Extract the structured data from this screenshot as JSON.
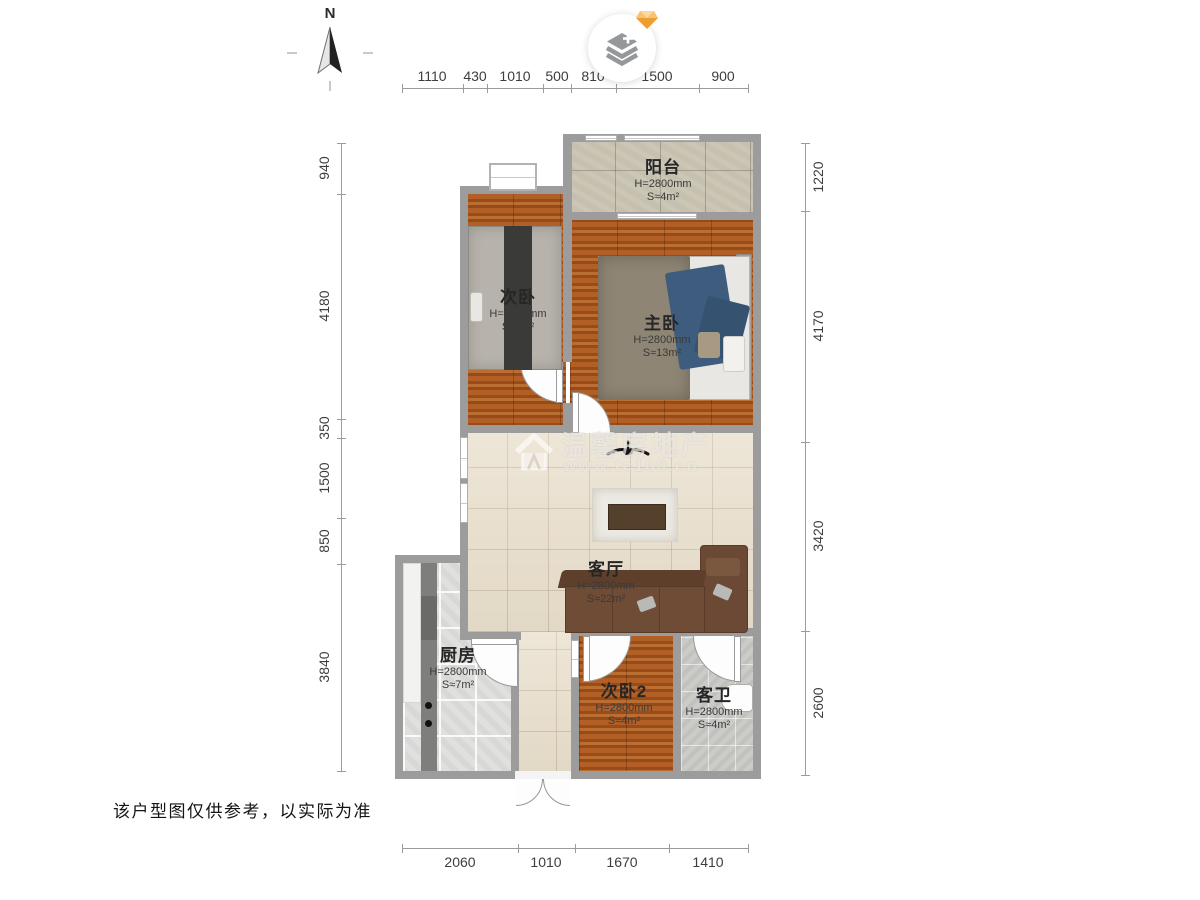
{
  "page": {
    "disclaimer": "该户型图仅供参考，以实际为准",
    "watermark": {
      "brand": "温馨房地产",
      "url": "www.tc100.cn"
    }
  },
  "compass": {
    "label": "N"
  },
  "icons": {
    "layers_button": "layers-plus-icon",
    "badge": "gem-icon",
    "compass": "north-arrow-icon",
    "fan": "ceiling-fan-icon",
    "watermark_logo": "house-logo-icon"
  },
  "colors": {
    "wall": "#9c9c9c",
    "wood_floor": "#a8561f",
    "tile_living": "#e9dfcc",
    "tile_kitchen": "#e0e0de",
    "tile_bath": "#cbcbc8",
    "tile_balcony": "#c6c0ae",
    "sofa": "#6b4934",
    "badge_accent": "#f4a93c"
  },
  "dimensions": {
    "top": [
      "1110",
      "430",
      "1010",
      "500",
      "810",
      "1500",
      "900"
    ],
    "left": [
      "940",
      "4180",
      "350",
      "1500",
      "850",
      "3840"
    ],
    "right": [
      "1220",
      "4170",
      "3420",
      "2600"
    ],
    "bottom": [
      "2060",
      "1010",
      "1670",
      "1410"
    ]
  },
  "rooms": {
    "balcony": {
      "name": "阳台",
      "height": "H=2800mm",
      "area": "S≈4m²"
    },
    "bedroom2": {
      "name": "次卧",
      "height": "H=2800mm",
      "area": "S≈8m²"
    },
    "master": {
      "name": "主卧",
      "height": "H=2800mm",
      "area": "S≈13m²"
    },
    "living": {
      "name": "客厅",
      "height": "H=2800mm",
      "area": "S≈22m²"
    },
    "kitchen": {
      "name": "厨房",
      "height": "H=2800mm",
      "area": "S≈7m²"
    },
    "bedroom3": {
      "name": "次卧2",
      "height": "H=2800mm",
      "area": "S≈4m²"
    },
    "bath": {
      "name": "客卫",
      "height": "H=2800mm",
      "area": "S≈4m²"
    }
  }
}
